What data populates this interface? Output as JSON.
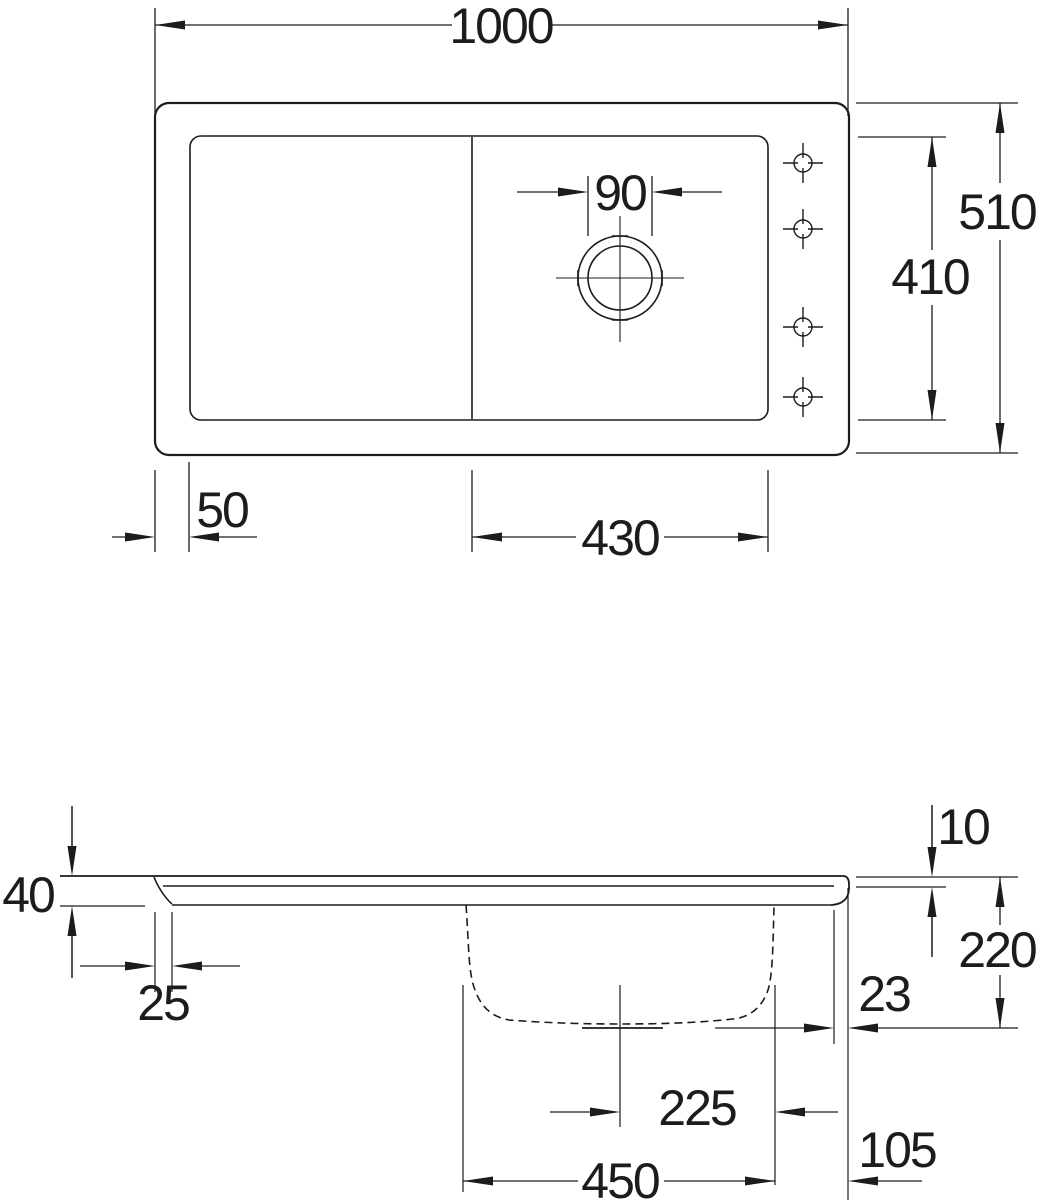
{
  "drawing": {
    "type": "kitchen-sink-technical-drawing",
    "views": {
      "top_view_name": "plan view",
      "side_view_name": "section view"
    },
    "colors": {
      "line": "#1c1c1c",
      "background": "#ffffff"
    },
    "dimensions": {
      "top_view": {
        "overall_width": "1000",
        "drain_hole": "90",
        "inner_depth": "410",
        "overall_depth": "510",
        "left_rim": "50",
        "bowl_width": "430"
      },
      "side_view": {
        "left_edge_height": "40",
        "front_lip": "25",
        "rim_step": "10",
        "bowl_depth": "220",
        "rear_lip": "23",
        "drain_center_offset": "225",
        "bowl_outer_width": "450",
        "right_overhang": "105"
      }
    }
  }
}
